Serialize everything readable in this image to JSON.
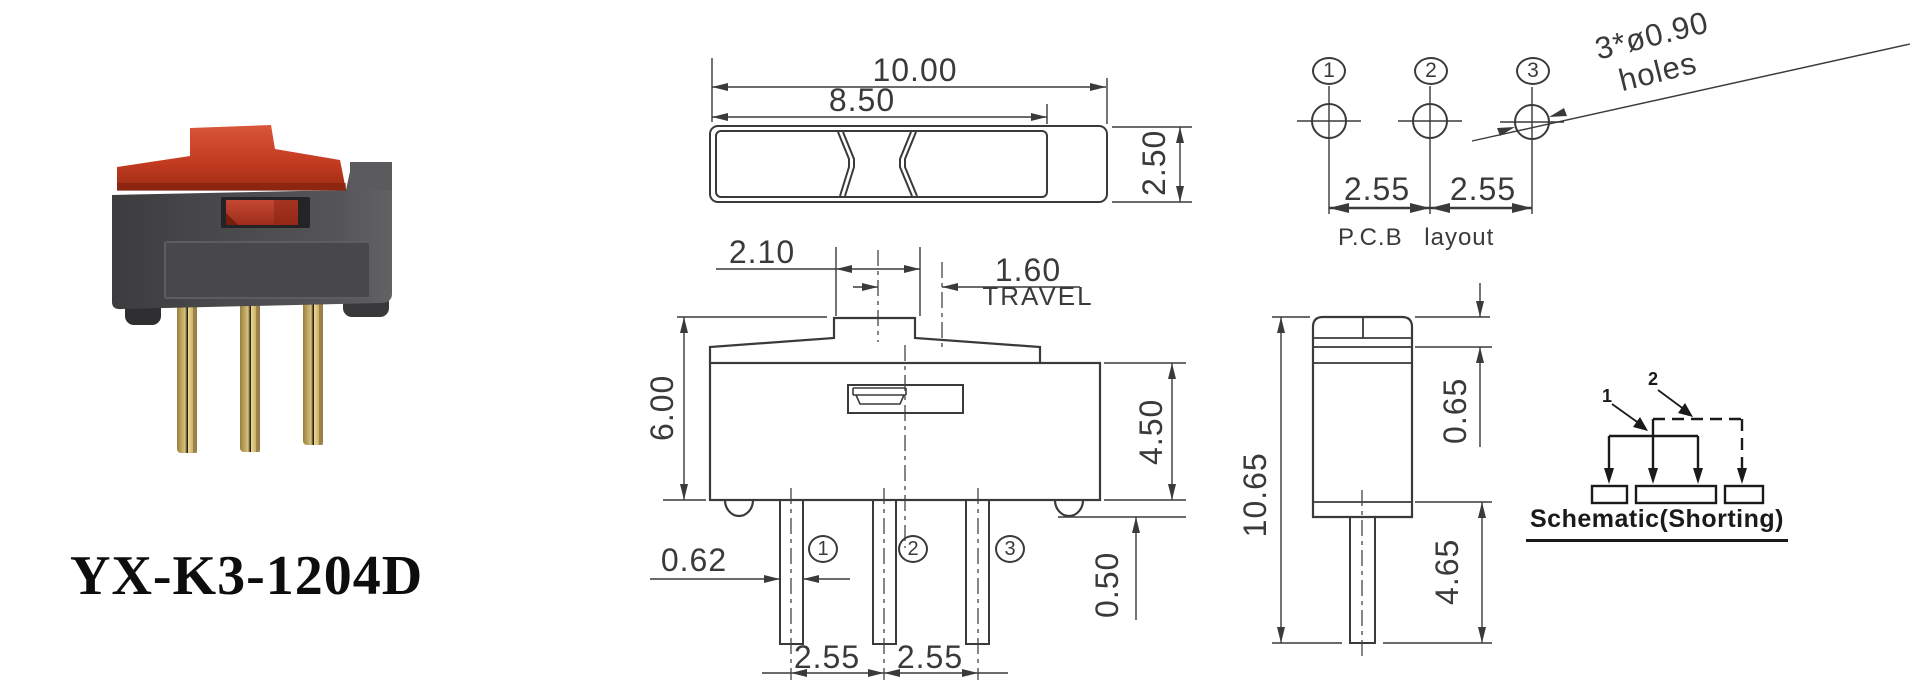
{
  "product": {
    "model": "YX-K3-1204D"
  },
  "top_view": {
    "dim_outer_width": "10.00",
    "dim_inner_width": "8.50",
    "dim_height": "2.50"
  },
  "front_view": {
    "dim_knob_width": "2.10",
    "dim_travel": "1.60",
    "travel_label": "TRAVEL",
    "dim_total_height": "6.00",
    "dim_body_height": "4.50",
    "dim_pin_width": "0.62",
    "dim_standoff": "0.50",
    "dim_pitch_left": "2.55",
    "dim_pitch_right": "2.55",
    "pin_numbers": [
      "1",
      "2",
      "3"
    ]
  },
  "pcb_layout": {
    "pin_numbers": [
      "1",
      "2",
      "3"
    ],
    "dim_pitch_left": "2.55",
    "dim_pitch_right": "2.55",
    "holes_note_line1": "3*ø0.90",
    "holes_note_line2": "holes",
    "caption": "P.C.B layout"
  },
  "side_view": {
    "dim_total_height": "10.65",
    "dim_cap_height": "0.65",
    "dim_pin_length": "4.65"
  },
  "schematic": {
    "pin1_label": "1",
    "pin2_label": "2",
    "caption": "Schematic(Shorting)"
  },
  "colors": {
    "line": "#3a3a3a",
    "schematic_line": "#1a1a1a",
    "actuator_red": "#c8402a",
    "body_gray": "#4b4b4d",
    "pin_gold": "#d9c07b"
  }
}
